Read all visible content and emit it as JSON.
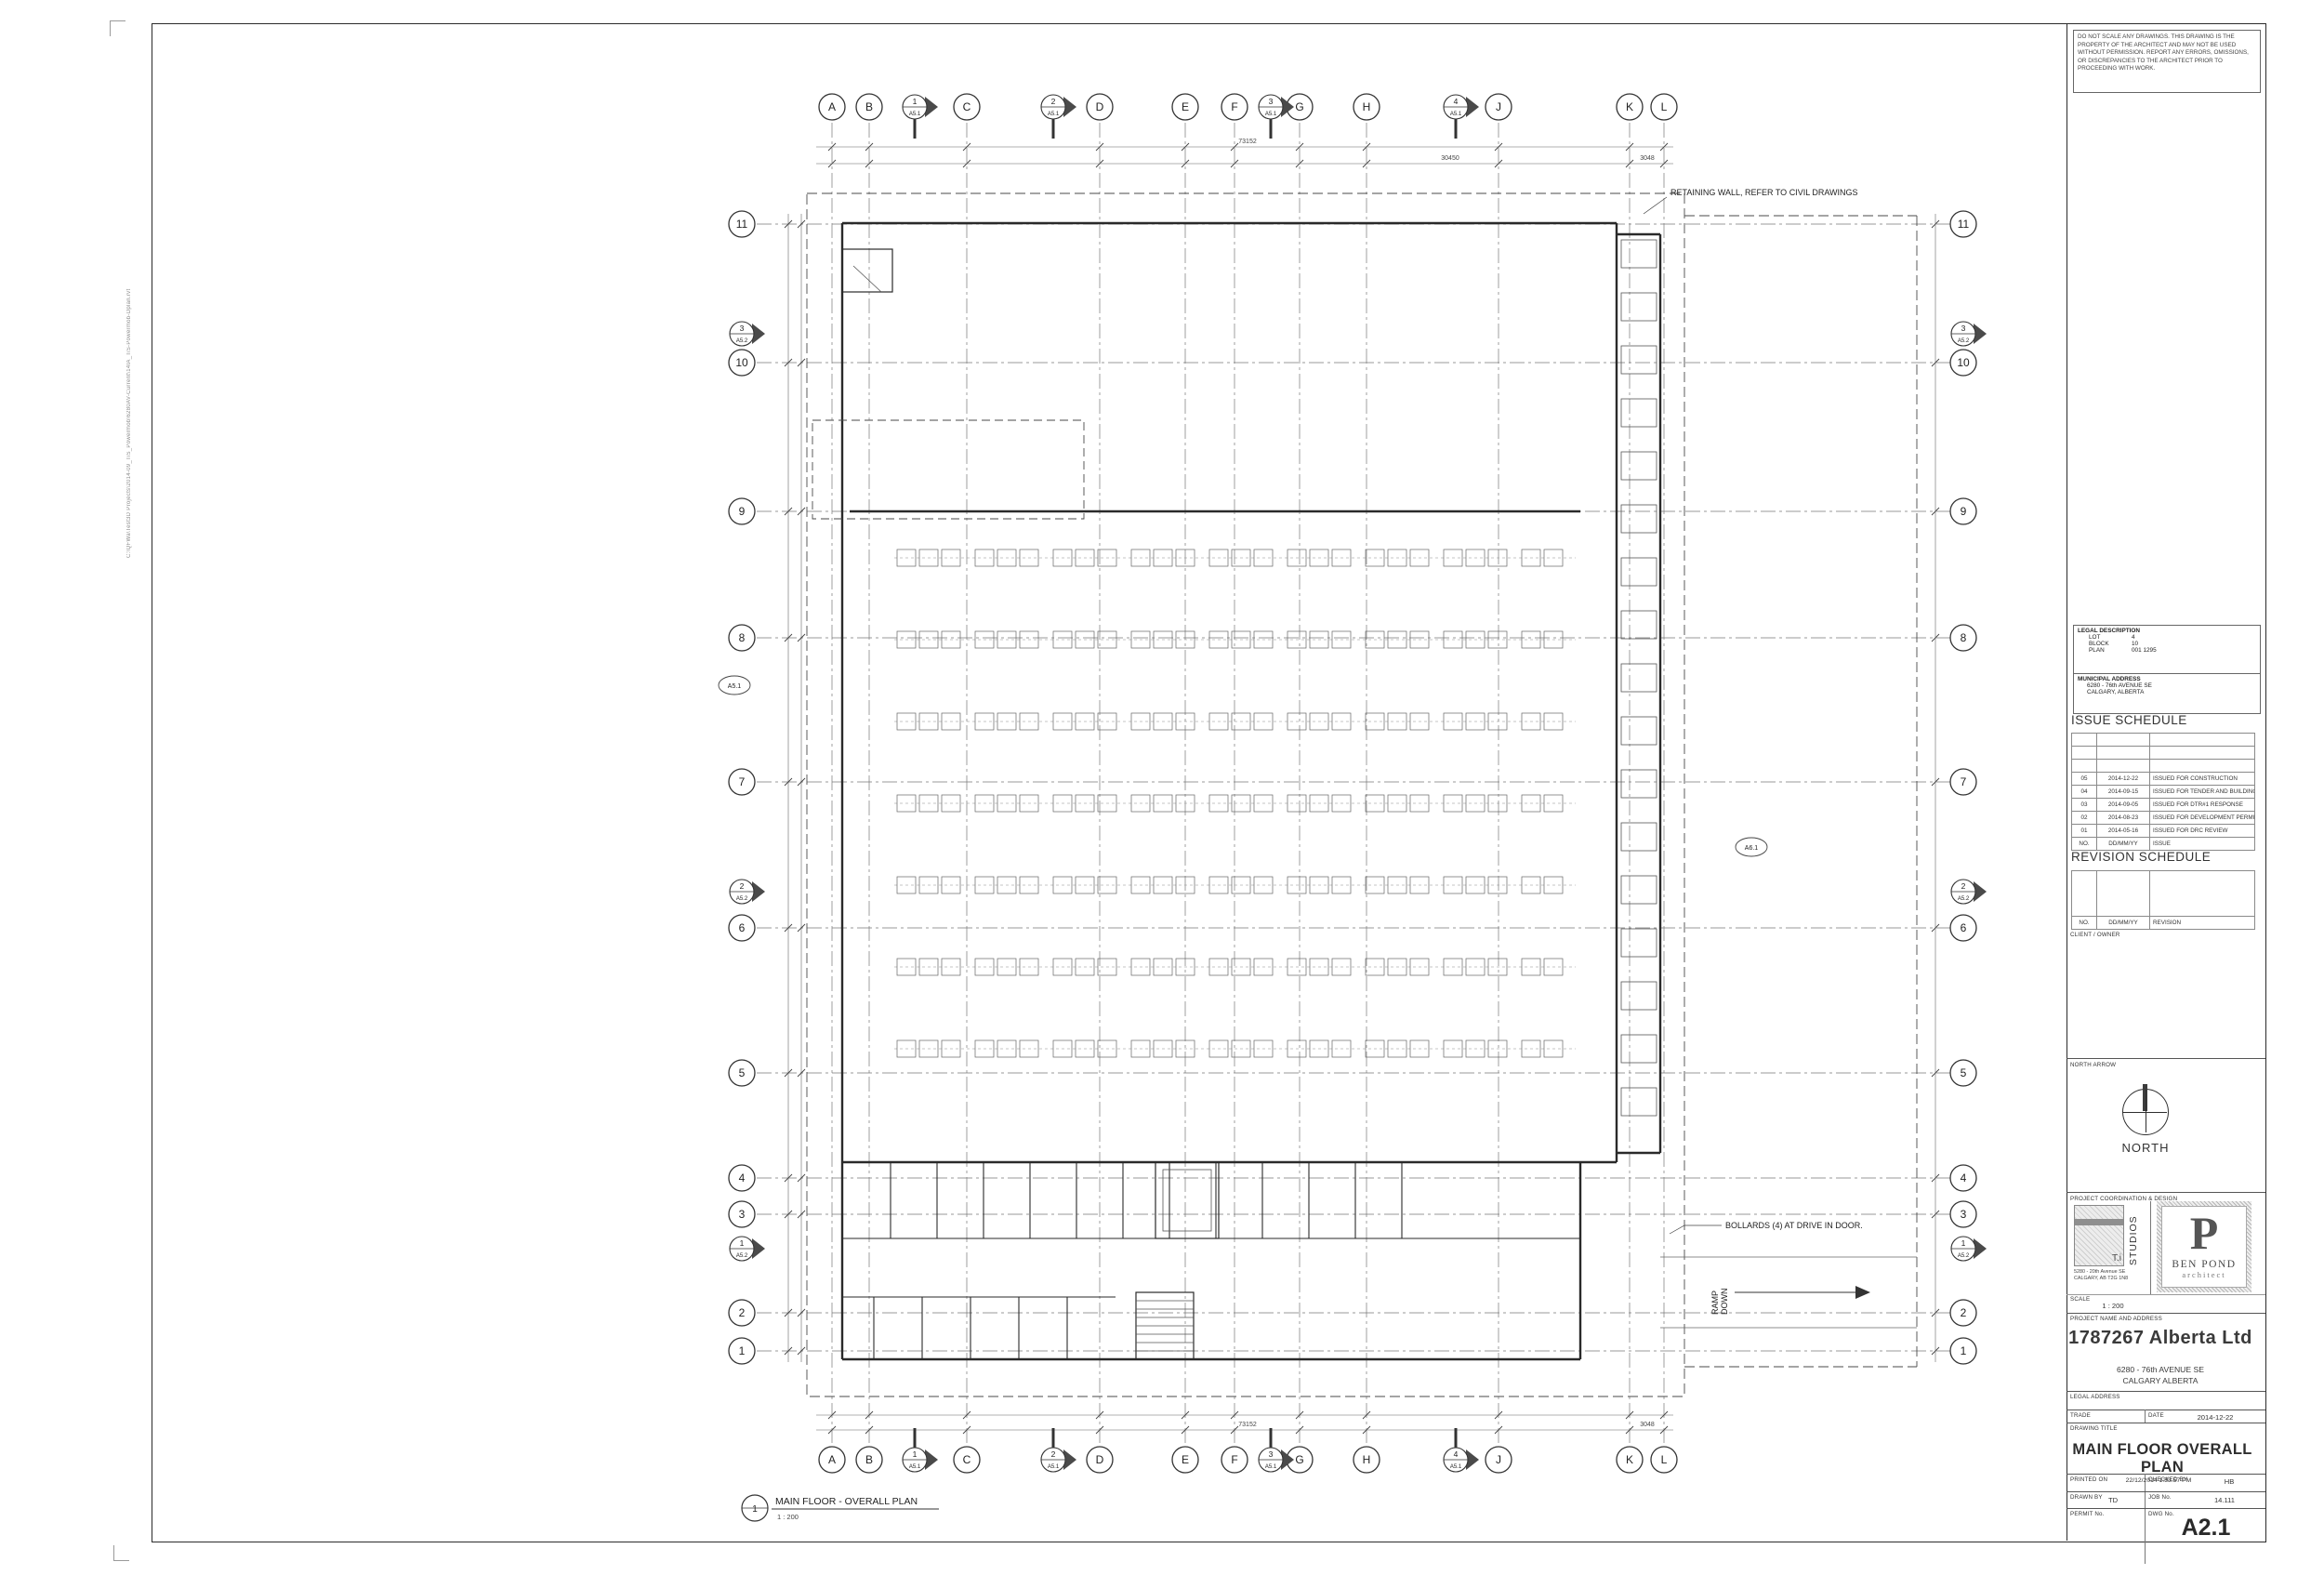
{
  "sheet": {
    "disclaimer": "DO NOT SCALE ANY DRAWINGS. THIS DRAWING IS THE PROPERTY OF THE ARCHITECT AND MAY NOT BE USED WITHOUT PERMISSION. REPORT ANY ERRORS, OMISSIONS, OR DISCREPANCIES TO THE ARCHITECT PRIOR TO PROCEEDING WITH WORK.",
    "file_path_note": "C:\\QFWa\\Test3D Projects\\2014-09_TiS_Powermob\\6280AV-Current\\14IA_TiS-Powermob-Dplan.rvt"
  },
  "titleblock": {
    "legal": {
      "heading": "LEGAL DESCRIPTION",
      "rows": [
        [
          "LOT",
          "4"
        ],
        [
          "BLOCK",
          "10"
        ],
        [
          "PLAN",
          "001 1295"
        ]
      ]
    },
    "municipal": {
      "heading": "MUNICIPAL ADDRESS",
      "lines": [
        "6280 - 76th AVENUE SE",
        "CALGARY, ALBERTA"
      ]
    },
    "issue_schedule": {
      "heading": "ISSUE SCHEDULE",
      "rows": [
        [
          "05",
          "2014-12-22",
          "ISSUED FOR CONSTRUCTION"
        ],
        [
          "04",
          "2014-09-15",
          "ISSUED FOR TENDER AND BUILDING PERMIT"
        ],
        [
          "03",
          "2014-09-05",
          "ISSUED FOR DTR#1 RESPONSE"
        ],
        [
          "02",
          "2014-08-23",
          "ISSUED FOR DEVELOPMENT PERMIT"
        ],
        [
          "01",
          "2014-05-16",
          "ISSUED FOR DRC REVIEW"
        ]
      ],
      "footer": [
        "NO.",
        "DD/MM/YY",
        "ISSUE"
      ]
    },
    "revision_schedule": {
      "heading": "REVISION SCHEDULE",
      "footer": [
        "NO.",
        "DD/MM/YY",
        "REVISION"
      ]
    },
    "client_owner_label": "CLIENT / OWNER",
    "north_label": "NORTH ARROW",
    "north_caption": "NORTH",
    "coordination_label": "PROJECT COORDINATION & DESIGN",
    "studio": {
      "mark": "T.i",
      "word": "STUDIOS",
      "addr1": "5280 - 20th Avenue SE",
      "addr2": "CALGARY, AB  T2G 1N8"
    },
    "architect": {
      "initial": "P",
      "name": "BEN POND",
      "word": "architect"
    },
    "scale_label": "SCALE",
    "scale_value": "1 : 200",
    "project_label": "PROJECT NAME AND ADDRESS",
    "project_name": "1787267 Alberta Ltd",
    "project_addr1": "6280 - 76th AVENUE SE",
    "project_addr2": "CALGARY ALBERTA",
    "legal_address_label": "LEGAL ADDRESS",
    "trade_label": "TRADE",
    "date_label": "DATE",
    "date_value": "2014-12-22",
    "drawing_title_label": "DRAWING TITLE",
    "drawing_title": "MAIN FLOOR OVERALL PLAN",
    "printed_label": "PRINTED ON",
    "printed_value": "22/12/2014 1:53:57 PM",
    "checked_label": "CHECKED BY",
    "checked_value": "HB",
    "drawn_label": "DRAWN BY",
    "drawn_value": "TD",
    "job_label": "JOB No.",
    "job_value": "14.111",
    "permit_label": "PERMIT No.",
    "permit_value": "",
    "dwg_label": "DWG No.",
    "dwg_value": "A2.1"
  },
  "plan": {
    "grid_columns": [
      "A",
      "B",
      "C",
      "D",
      "E",
      "F",
      "G",
      "H",
      "J",
      "K",
      "L"
    ],
    "grid_rows": [
      "11",
      "10",
      "9",
      "8",
      "7",
      "6",
      "5",
      "4",
      "3",
      "2",
      "1"
    ],
    "section_markers_top": [
      {
        "num": "1",
        "sheet": "A5.1"
      },
      {
        "num": "2",
        "sheet": "A5.1"
      },
      {
        "num": "3",
        "sheet": "A5.1"
      },
      {
        "num": "4",
        "sheet": "A5.1"
      }
    ],
    "section_markers_side": [
      {
        "num": "3",
        "sheet": "A5.2"
      },
      {
        "num": "2",
        "sheet": "A5.2"
      },
      {
        "num": "1",
        "sheet": "A5.2"
      }
    ],
    "detail_markers": [
      "A5.1",
      "A6.1"
    ],
    "notes": {
      "retaining": "RETAINING WALL, REFER TO CIVIL DRAWINGS",
      "bollards": "BOLLARDS (4) AT DRIVE IN DOOR.",
      "ramp_line1": "RAMP",
      "ramp_line2": "DOWN"
    },
    "dims": {
      "overall": "73152",
      "mid": "30450",
      "right": "3048"
    },
    "callout_num": "1",
    "callout_title": "MAIN FLOOR - OVERALL PLAN",
    "callout_scale": "1 : 200"
  }
}
